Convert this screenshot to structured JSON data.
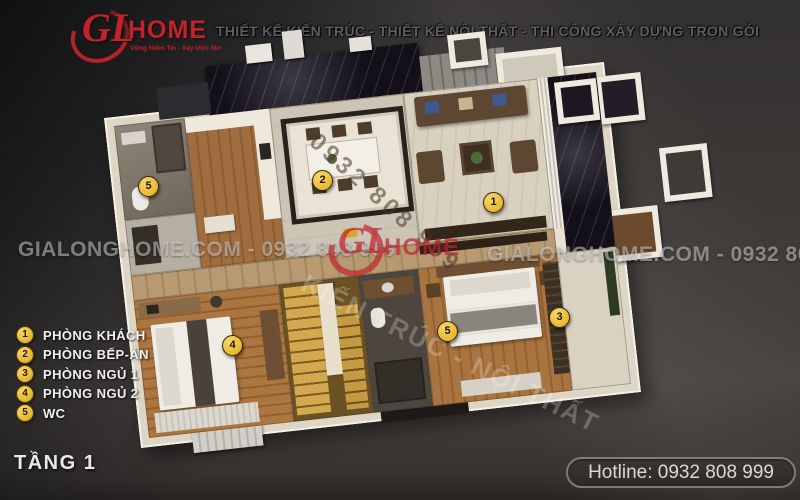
{
  "header": {
    "logo": {
      "gl": "GL",
      "home": "HOME",
      "slogan": "Vững Niềm Tin - Xây Ước Mơ"
    },
    "tagline": "THIẾT KẾ KIẾN TRÚC - THIẾT KẾ NỘI THẤT - THI CÔNG XÂY DỰNG TRỌN GÓI"
  },
  "watermarks": {
    "band_left": "GIALONGHOME.COM - 0932 808 999",
    "band_right": "GIALONGHOME.COM - 0932 808 999",
    "phone_diagonal": "0932 808 999",
    "services_diagonal": "KIẾN TRÚC - NỘI THẤT",
    "center_logo_gl": "GL",
    "center_logo_home": "HOME"
  },
  "legend": {
    "items": [
      {
        "num": "1",
        "label": "PHÒNG KHÁCH"
      },
      {
        "num": "2",
        "label": "PHÒNG BẾP-ĂN"
      },
      {
        "num": "3",
        "label": "PHÒNG NGỦ 1"
      },
      {
        "num": "4",
        "label": "PHÒNG NGỦ 2"
      },
      {
        "num": "5",
        "label": "WC"
      }
    ]
  },
  "plan": {
    "markers": [
      {
        "num": "1",
        "room": "living-room"
      },
      {
        "num": "2",
        "label_room": "kitchen-dining",
        "room": "kitchen-dining"
      },
      {
        "num": "3",
        "room": "bedroom-1"
      },
      {
        "num": "4",
        "room": "bedroom-2"
      },
      {
        "num": "5",
        "room": "wc-upper"
      },
      {
        "num": "5",
        "room": "wc-middle"
      }
    ]
  },
  "footer": {
    "floor_title": "TẦNG 1",
    "hotline": "Hotline: 0932 808 999"
  },
  "colors": {
    "brand_red": "#c0232b",
    "badge_yellow": "#e8b92f",
    "background": "#3b3836",
    "plan_wall": "#e9e2d3",
    "marble_black": "#14101a",
    "stair_gold": "#c9a24f"
  }
}
